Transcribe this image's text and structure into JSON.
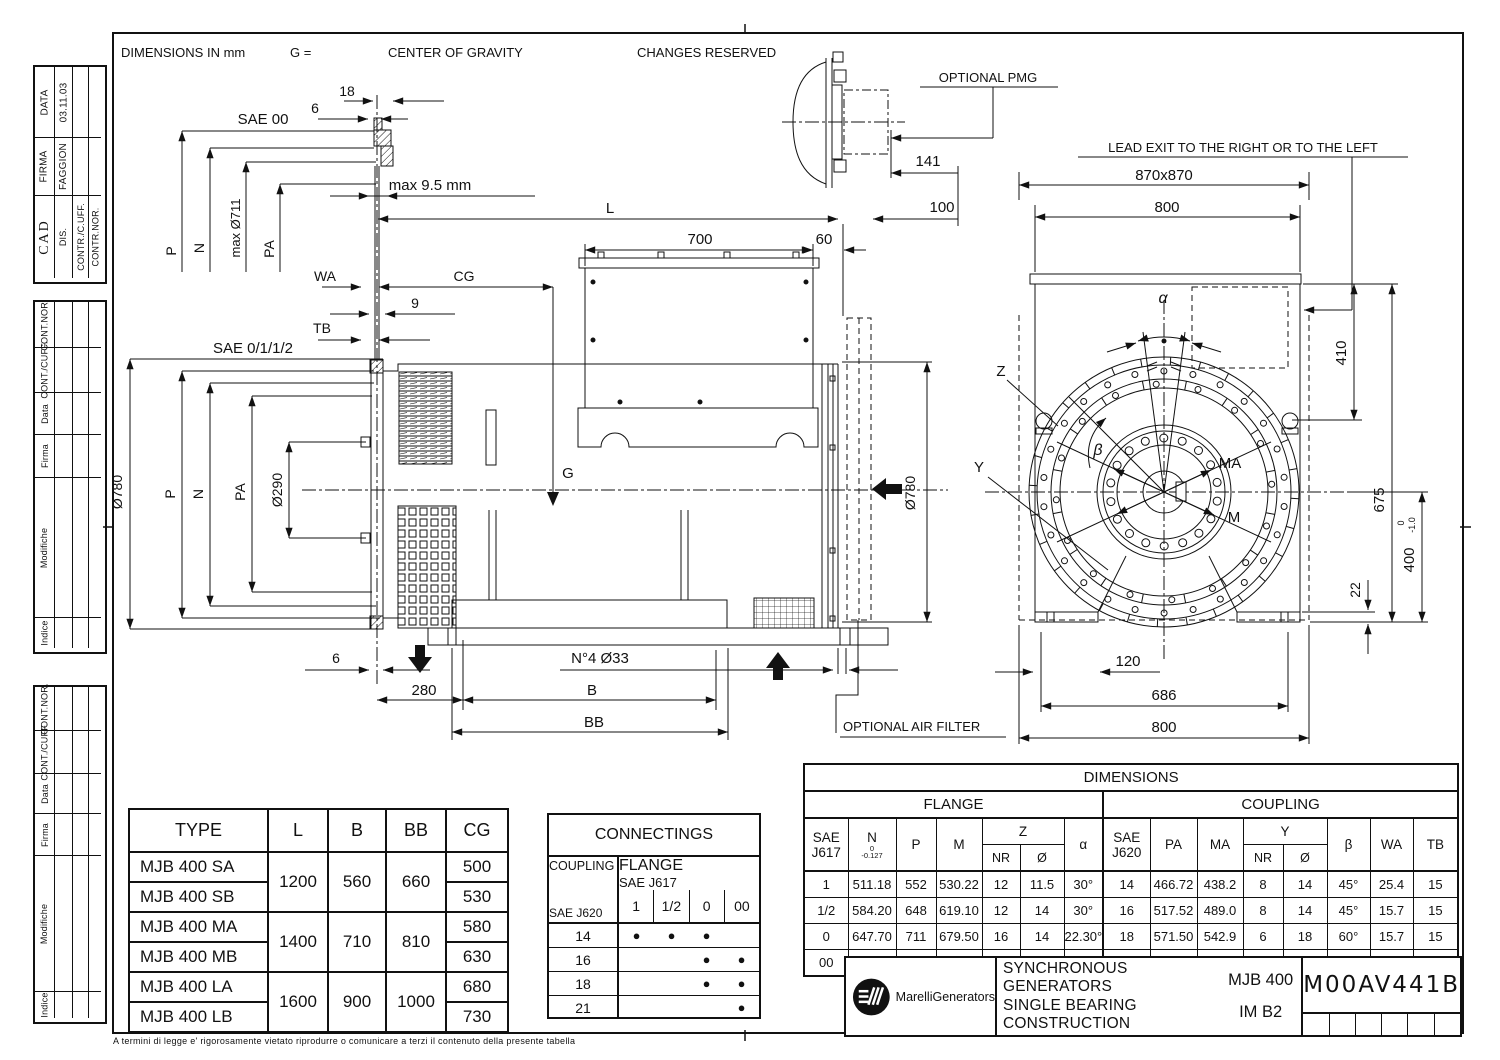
{
  "page": {
    "note_dimensions": "DIMENSIONS IN mm",
    "note_g": "G =",
    "note_cog": "CENTER OF GRAVITY",
    "note_changes": "CHANGES RESERVED",
    "footer_legal": "A termini di legge e' rigorosamente vietato riprodurre o comunicare a terzi il contenuto della presente tabella"
  },
  "cad_block": {
    "cad": "CAD",
    "dis": "DIS.",
    "contr_cuff": "CONTR./C.UFF.",
    "contr_nor": "CONTR.NOR.",
    "firma_label": "FIRMA",
    "firma_value": "FAGGION",
    "data_label": "DATA",
    "data_value": "03.11.03"
  },
  "revision_block": {
    "cont_nor": "CONT.NOR.",
    "cont_cuff": "CONT./CUFF.",
    "data": "Data",
    "firma": "Firma",
    "modifiche": "Modifiche",
    "indice": "Indice"
  },
  "side_view": {
    "sae00": "SAE 00",
    "dim18": "18",
    "dim6_top": "6",
    "max711": "max Ø711",
    "p_top": "P",
    "n_top": "N",
    "pa_top": "PA",
    "max95": "max 9.5 mm",
    "dimL": "L",
    "dim700": "700",
    "dim60": "60",
    "dim141": "141",
    "dim100": "100",
    "pmg": "OPTIONAL PMG",
    "wa": "WA",
    "cg": "CG",
    "dim9": "9",
    "tb": "TB",
    "sae0112": "SAE 0/1/1/2",
    "dia780": "Ø780",
    "p": "P",
    "n": "N",
    "pa": "PA",
    "dia290": "Ø290",
    "g": "G",
    "dia780r": "Ø780",
    "dim6_bot": "6",
    "dim280": "280",
    "b": "B",
    "bb": "BB",
    "n4": "N°4 Ø33",
    "air_filter": "OPTIONAL AIR FILTER"
  },
  "front_view": {
    "lead_exit": "LEAD EXIT TO THE RIGHT OR TO THE LEFT",
    "dim870": "870x870",
    "dim800_top": "800",
    "dim410": "410",
    "dim675": "675",
    "dim400": "400",
    "tol0": "0",
    "tol10": "-1.0",
    "dim22": "22",
    "dim120": "120",
    "dim686": "686",
    "dim800_bot": "800",
    "alpha": "α",
    "beta": "β",
    "z": "Z",
    "y": "Y",
    "ma": "MA",
    "m": "M"
  },
  "type_table": {
    "headers": [
      "TYPE",
      "L",
      "B",
      "BB",
      "CG"
    ],
    "groups": [
      {
        "type_a": "MJB 400 SA",
        "type_b": "MJB 400 SB",
        "l": "1200",
        "b": "560",
        "bb": "660",
        "cg_a": "500",
        "cg_b": "530"
      },
      {
        "type_a": "MJB 400 MA",
        "type_b": "MJB 400 MB",
        "l": "1400",
        "b": "710",
        "bb": "810",
        "cg_a": "580",
        "cg_b": "630"
      },
      {
        "type_a": "MJB 400 LA",
        "type_b": "MJB 400 LB",
        "l": "1600",
        "b": "900",
        "bb": "1000",
        "cg_a": "680",
        "cg_b": "730"
      }
    ]
  },
  "connectings": {
    "title": "CONNECTINGS",
    "coupling_label": "COUPLING",
    "flange_label": "FLANGE",
    "sae_j617": "SAE J617",
    "sae_j620": "SAE J620",
    "cols": [
      "1",
      "1/2",
      "0",
      "00"
    ],
    "rows": [
      {
        "size": "14",
        "dots": [
          "●",
          "●",
          "●",
          ""
        ]
      },
      {
        "size": "16",
        "dots": [
          "",
          "",
          "●",
          "●"
        ]
      },
      {
        "size": "18",
        "dots": [
          "",
          "",
          "●",
          "●"
        ]
      },
      {
        "size": "21",
        "dots": [
          "",
          "",
          "",
          "●"
        ]
      }
    ]
  },
  "dim_table": {
    "title": "DIMENSIONS",
    "flange": "FLANGE",
    "coupling": "COUPLING",
    "sae": "SAE",
    "j617": "J617",
    "j620": "J620",
    "n": "N",
    "n_tol_top": "0",
    "n_tol_bot": "-0.127",
    "p": "P",
    "m": "M",
    "z": "Z",
    "nr": "NR",
    "dia": "Ø",
    "alpha": "α",
    "pa": "PA",
    "ma": "MA",
    "y": "Y",
    "beta": "β",
    "wa": "WA",
    "tb": "TB",
    "rows": [
      {
        "j617": "1",
        "n": "511.18",
        "p": "552",
        "m": "530.22",
        "znr": "12",
        "zd": "11.5",
        "alpha": "30°",
        "j620": "14",
        "pa": "466.72",
        "ma": "438.2",
        "ynr": "8",
        "yd": "14",
        "beta": "45°",
        "wa": "25.4",
        "tb": "15"
      },
      {
        "j617": "1/2",
        "n": "584.20",
        "p": "648",
        "m": "619.10",
        "znr": "12",
        "zd": "14",
        "alpha": "30°",
        "j620": "16",
        "pa": "517.52",
        "ma": "489.0",
        "ynr": "8",
        "yd": "14",
        "beta": "45°",
        "wa": "15.7",
        "tb": "15"
      },
      {
        "j617": "0",
        "n": "647.70",
        "p": "711",
        "m": "679.50",
        "znr": "16",
        "zd": "14",
        "alpha": "22.30°",
        "j620": "18",
        "pa": "571.50",
        "ma": "542.9",
        "ynr": "6",
        "yd": "18",
        "beta": "60°",
        "wa": "15.7",
        "tb": "15"
      },
      {
        "j617": "00",
        "n": "787.40",
        "p": "883",
        "m": "851.00",
        "znr": "16",
        "zd": "14",
        "alpha": "22.30°",
        "j620": "21",
        "pa": "673.10",
        "ma": "641.4",
        "ynr": "12",
        "yd": "18",
        "beta": "30°",
        "wa": "0",
        "tb": "31"
      }
    ]
  },
  "title_block": {
    "brand": "MarelliGenerators",
    "product_line1": "SYNCHRONOUS GENERATORS",
    "product_line2": "SINGLE BEARING CONSTRUCTION",
    "model": "MJB 400",
    "mounting": "IM B2",
    "drawing_number": "M00AV441B"
  }
}
